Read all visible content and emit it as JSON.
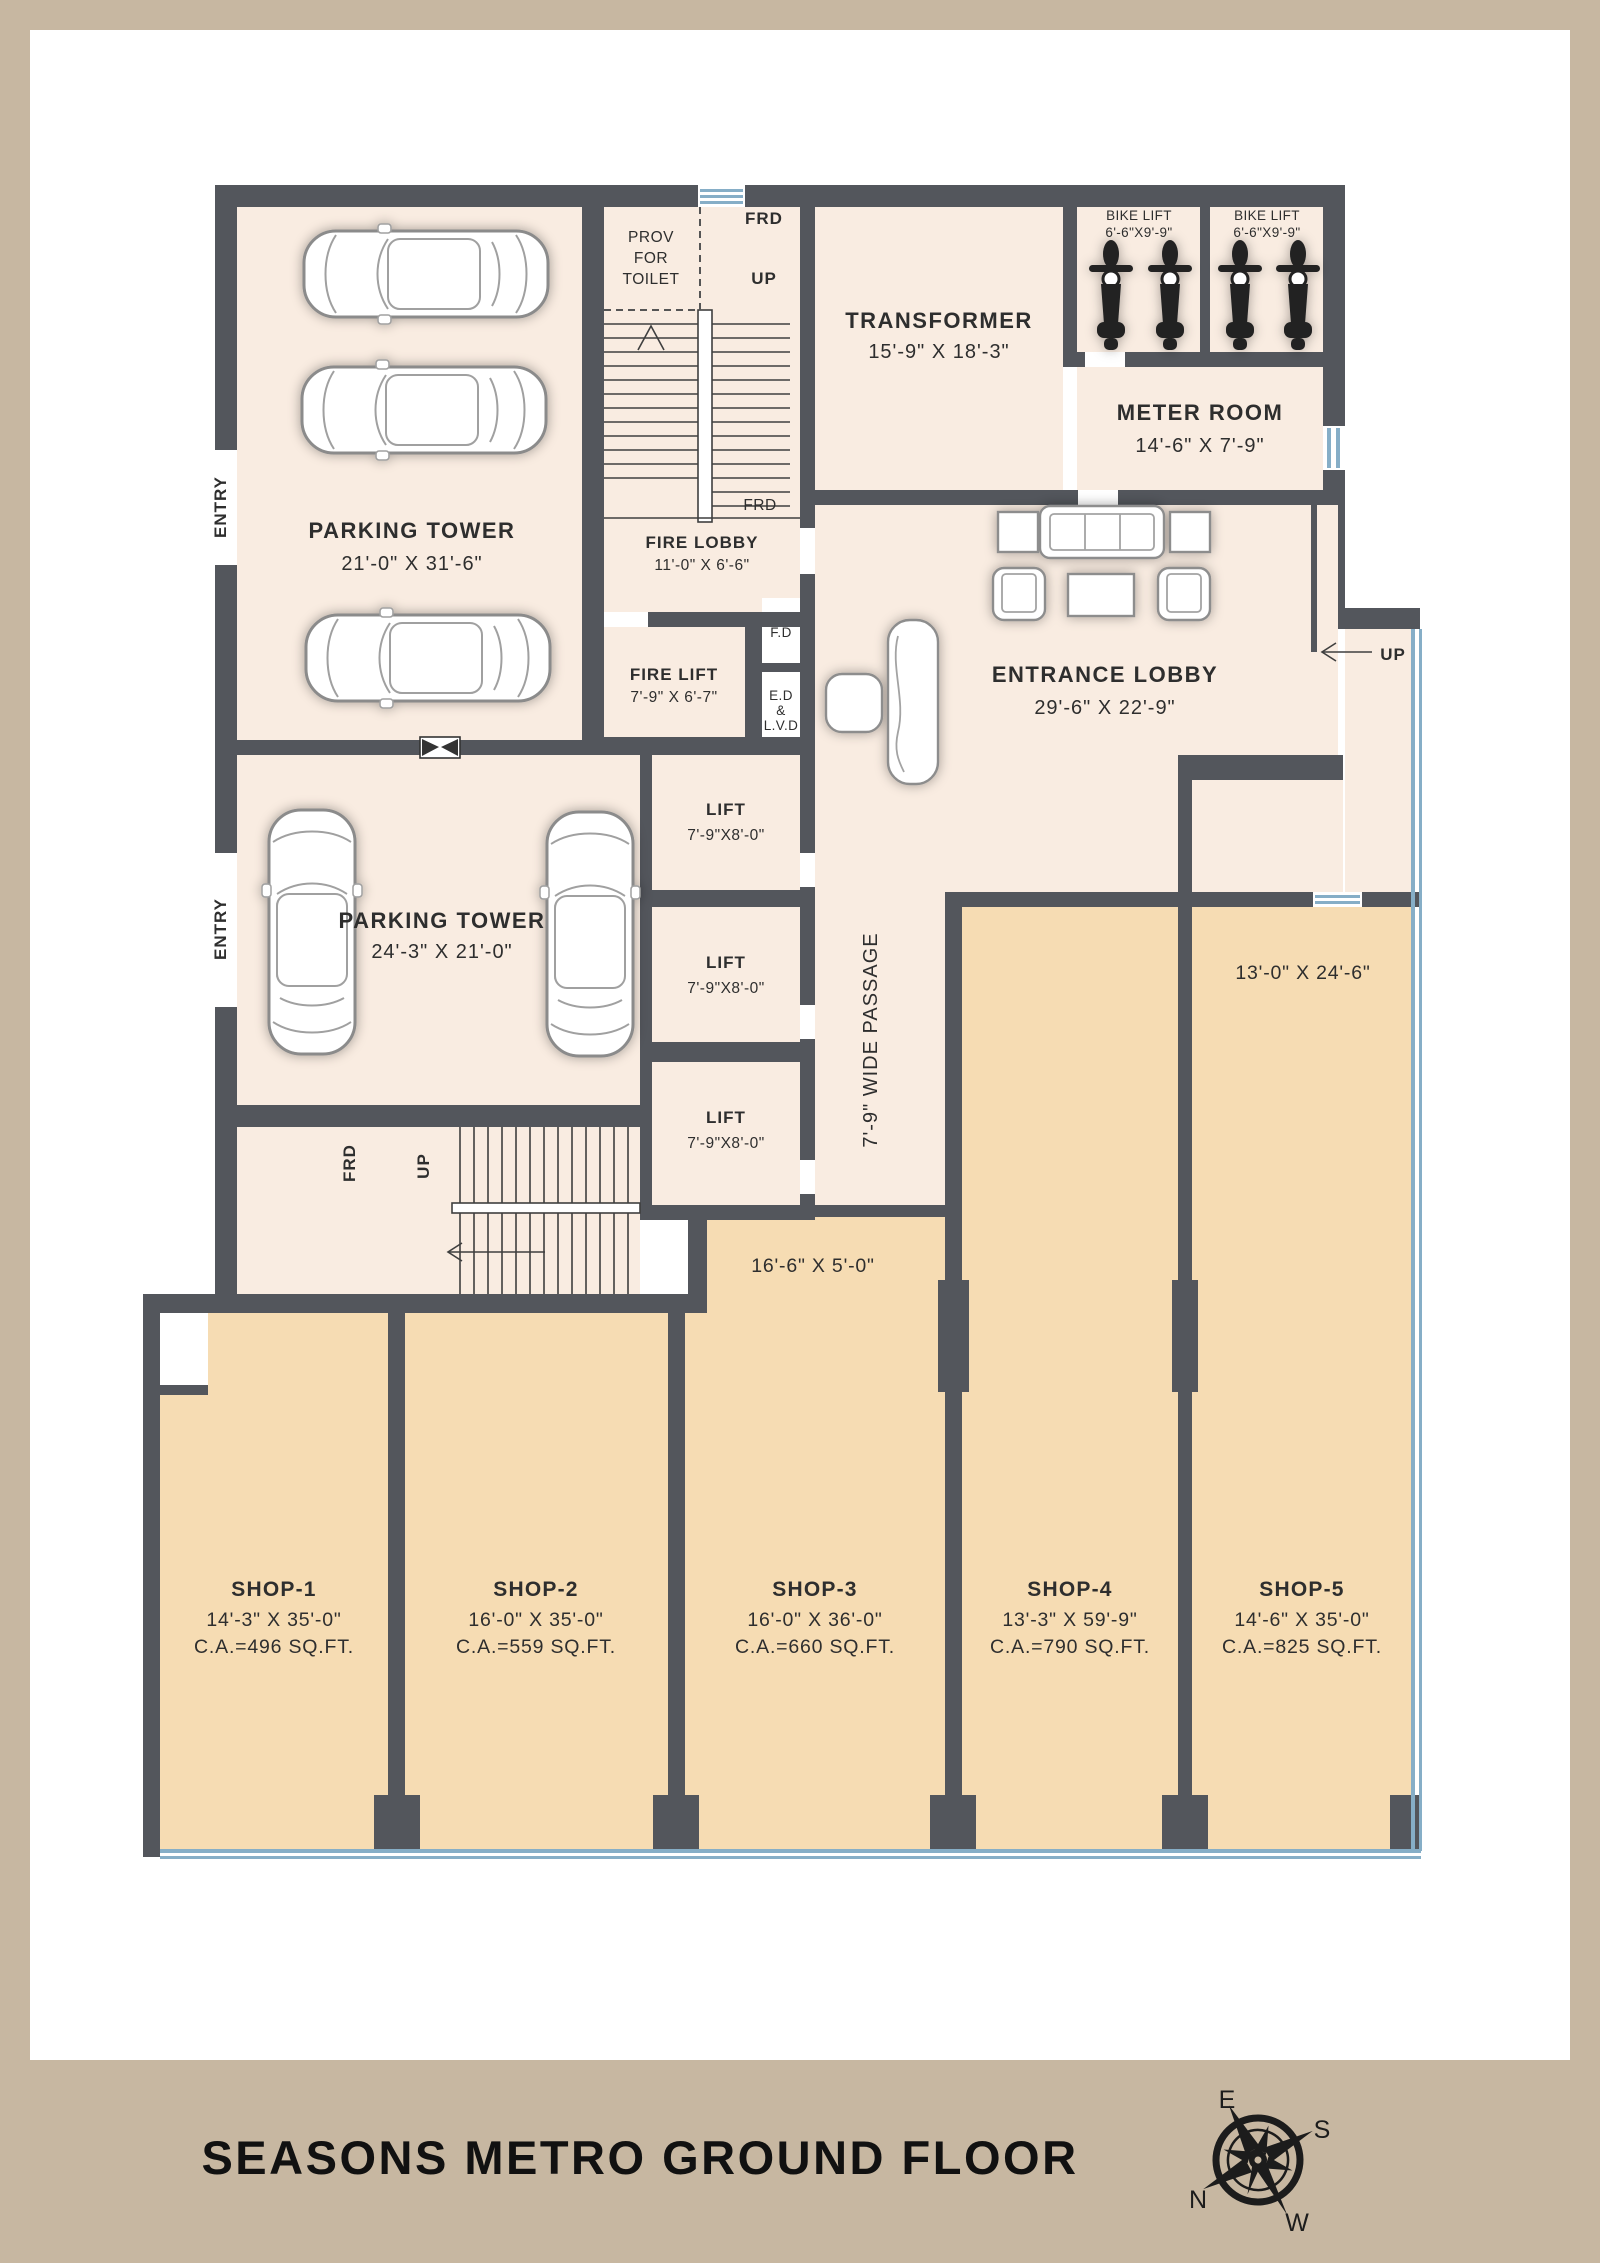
{
  "title": "SEASONS METRO GROUND FLOOR",
  "compass": {
    "n": "N",
    "e": "E",
    "s": "S",
    "w": "W"
  },
  "rooms": {
    "parking_tower_1": {
      "name": "PARKING TOWER",
      "dims": "21'-0\" X 31'-6\""
    },
    "parking_tower_2": {
      "name": "PARKING TOWER",
      "dims": "24'-3\" X 21'-0\""
    },
    "transformer": {
      "name": "TRANSFORMER",
      "dims": "15'-9\" X 18'-3\""
    },
    "meter_room": {
      "name": "METER ROOM",
      "dims": "14'-6\" X 7'-9\""
    },
    "bike_lift_1": {
      "name": "BIKE LIFT",
      "dims": "6'-6\"X9'-9\""
    },
    "bike_lift_2": {
      "name": "BIKE LIFT",
      "dims": "6'-6\"X9'-9\""
    },
    "entrance_lobby": {
      "name": "ENTRANCE LOBBY",
      "dims": "29'-6\" X 22'-9\""
    },
    "fire_lobby": {
      "name": "FIRE LOBBY",
      "dims": "11'-0\" X 6'-6\""
    },
    "fire_lift": {
      "name": "FIRE LIFT",
      "dims": "7'-9\" X 6'-7\""
    },
    "prov_toilet": {
      "line1": "PROV",
      "line2": "FOR",
      "line3": "TOILET"
    },
    "lift_1": {
      "name": "LIFT",
      "dims": "7'-9\"X8'-0\""
    },
    "lift_2": {
      "name": "LIFT",
      "dims": "7'-9\"X8'-0\""
    },
    "lift_3": {
      "name": "LIFT",
      "dims": "7'-9\"X8'-0\""
    },
    "fd_shaft": {
      "name": "F.D"
    },
    "ed_shaft": {
      "line1": "E.D",
      "line2": "&",
      "line3": "L.V.D"
    },
    "passage": {
      "name": "7'-9\" WIDE PASSAGE"
    }
  },
  "shops": [
    {
      "name": "SHOP-1",
      "dims": "14'-3\" X 35'-0\"",
      "area": "C.A.=496 SQ.FT."
    },
    {
      "name": "SHOP-2",
      "dims": "16'-0\" X 35'-0\"",
      "area": "C.A.=559 SQ.FT."
    },
    {
      "name": "SHOP-3",
      "dims": "16'-0\" X 36'-0\"",
      "area": "C.A.=660 SQ.FT."
    },
    {
      "name": "SHOP-4",
      "dims": "13'-3\" X 59'-9\"",
      "area": "C.A.=790 SQ.FT."
    },
    {
      "name": "SHOP-5",
      "dims": "14'-6\" X 35'-0\"",
      "area": "C.A.=825 SQ.FT."
    }
  ],
  "annotations": {
    "entry_1": "ENTRY",
    "entry_2": "ENTRY",
    "frd_top": "FRD",
    "up_top": "UP",
    "frd_mid": "FRD",
    "frd_bottom": "FRD",
    "up_bottom": "UP",
    "up_lobby": "UP",
    "shop3_front_dims": "16'-6\" X 5'-0\"",
    "shop5_upper_dims": "13'-0\" X 24'-6\""
  },
  "colors": {
    "frame": "#c7b7a1",
    "wall": "#53565c",
    "room_fill": "#f9ece1",
    "shop_fill": "#f6dcb3",
    "glass": "#86aec7",
    "text": "#2e2e2e"
  }
}
